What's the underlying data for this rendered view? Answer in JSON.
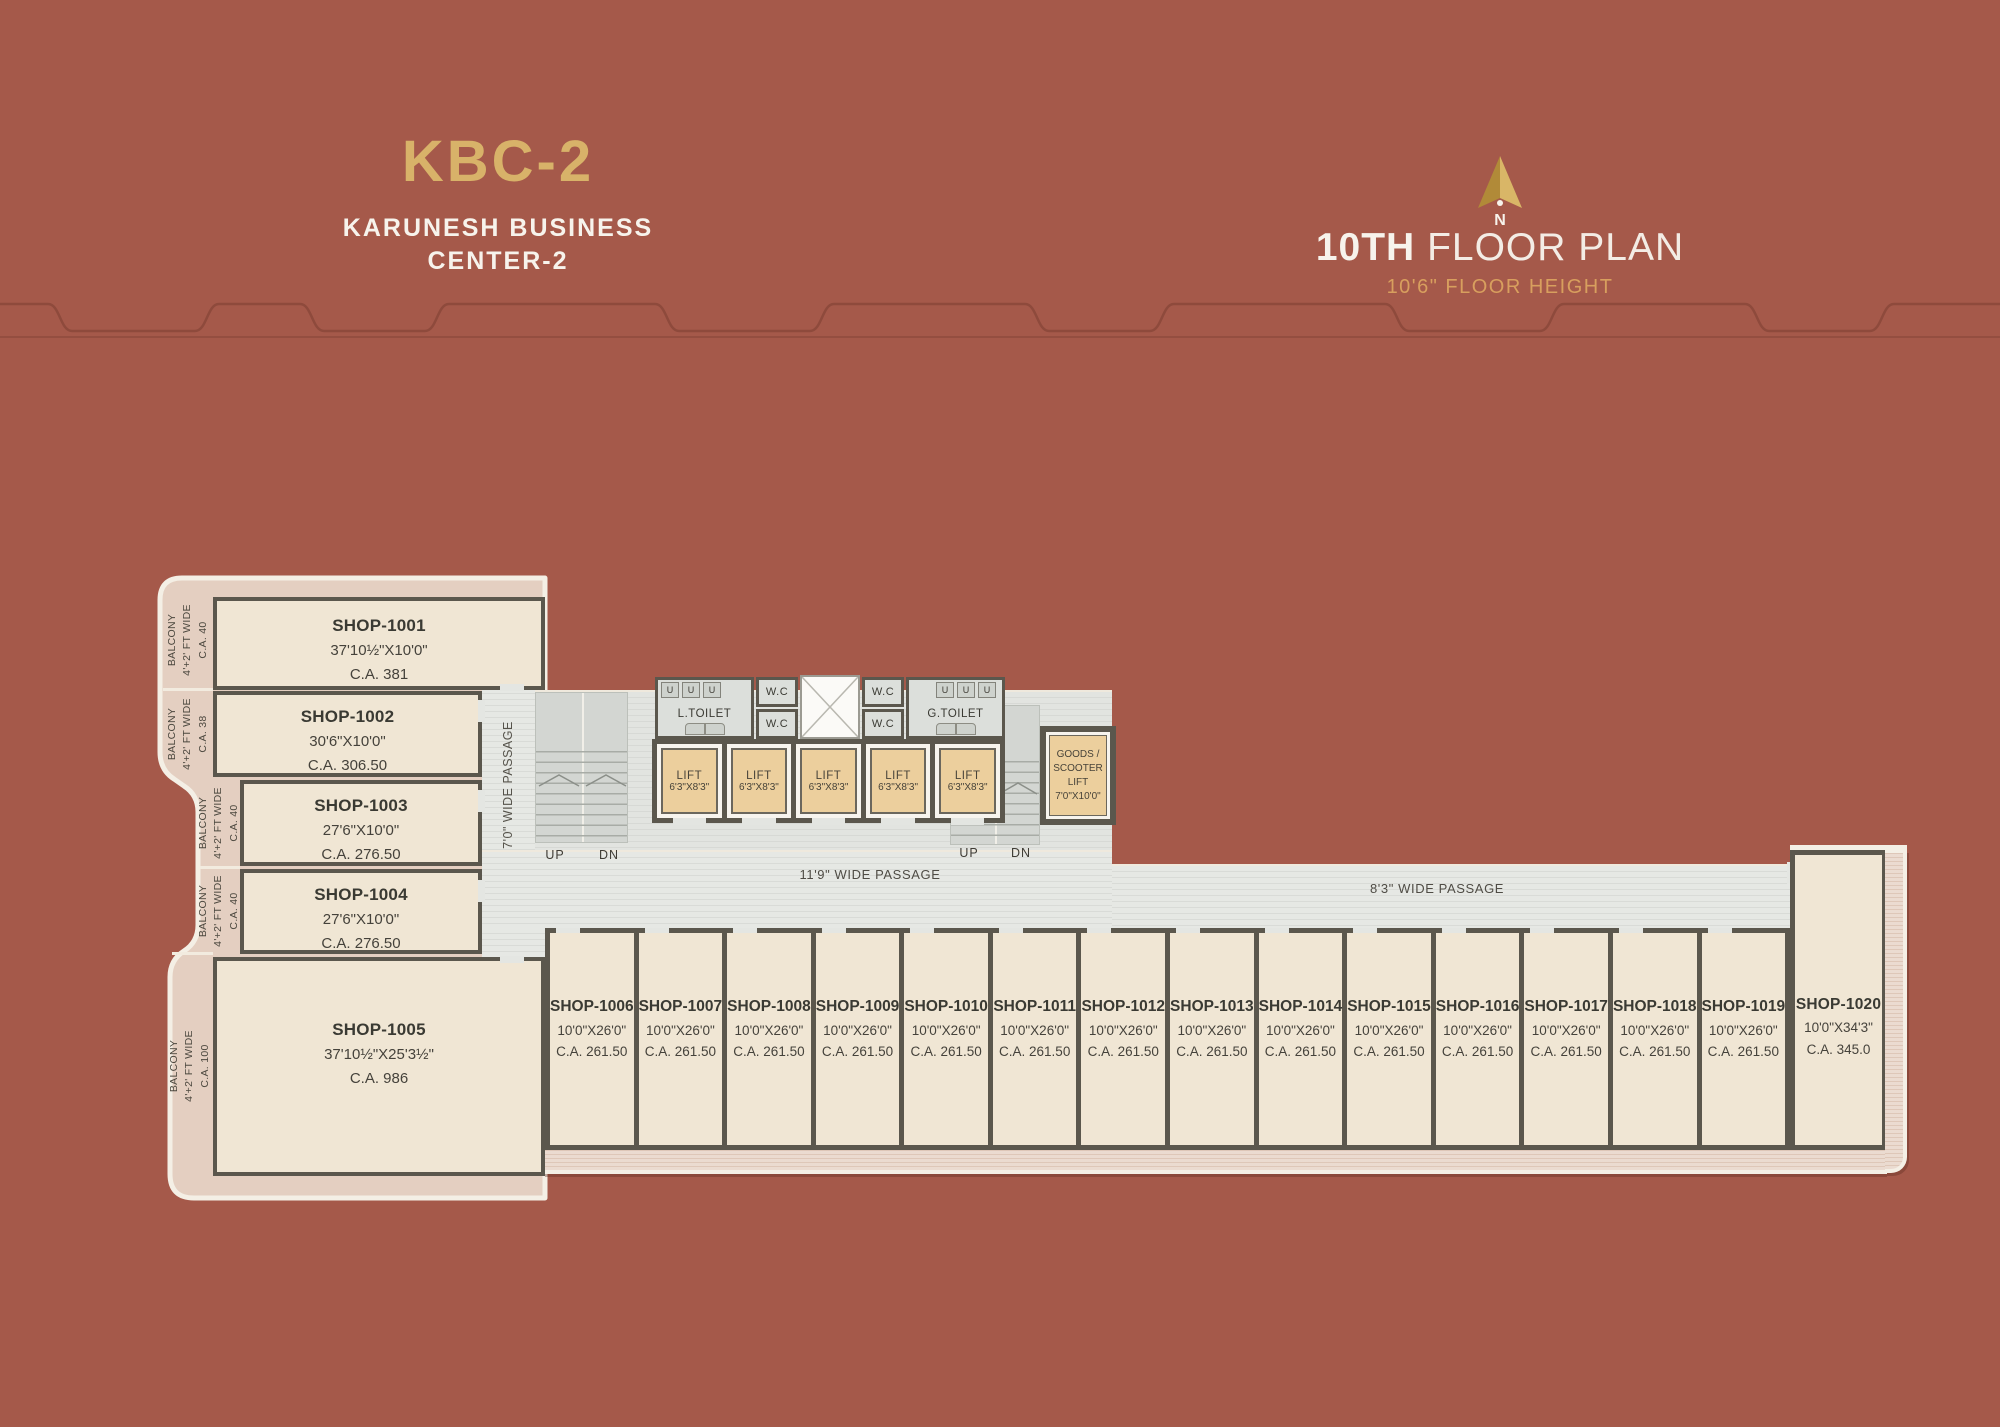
{
  "header": {
    "brand": "KBC-2",
    "brand_sub1": "KARUNESH BUSINESS",
    "brand_sub2": "CENTER-2",
    "north_letter": "N",
    "floor_title_bold": "10TH",
    "floor_title_rest": " FLOOR PLAN",
    "floor_height": "10'6\" FLOOR HEIGHT"
  },
  "plan": {
    "passage_vertical": "7'0\" WIDE PASSAGE",
    "passage_main": "11'9\" WIDE PASSAGE",
    "passage_right": "8'3\" WIDE PASSAGE",
    "stairs": {
      "up": "UP",
      "dn": "DN"
    },
    "core": {
      "l_toilet": "L.TOILET",
      "g_toilet": "G.TOILET",
      "wc": "W.C",
      "urinal": "U",
      "lift_label": "LIFT",
      "lift_size": "6'3\"X8'3\"",
      "goods_lift_lines": [
        "GOODS /",
        "SCOOTER",
        "LIFT",
        "7'0\"X10'0\""
      ]
    }
  },
  "balcony_label": {
    "line1": "BALCONY",
    "line2": "4'+2' FT WIDE"
  },
  "left_shops": [
    {
      "name": "SHOP-1001",
      "size": "37'10½\"X10'0\"",
      "ca": "C.A. 381",
      "balcony_ca": "C.A. 40"
    },
    {
      "name": "SHOP-1002",
      "size": "30'6\"X10'0\"",
      "ca": "C.A. 306.50",
      "balcony_ca": "C.A. 38"
    },
    {
      "name": "SHOP-1003",
      "size": "27'6\"X10'0\"",
      "ca": "C.A. 276.50",
      "balcony_ca": "C.A. 40"
    },
    {
      "name": "SHOP-1004",
      "size": "27'6\"X10'0\"",
      "ca": "C.A. 276.50",
      "balcony_ca": "C.A. 40"
    },
    {
      "name": "SHOP-1005",
      "size": "37'10½\"X25'3½\"",
      "ca": "C.A. 986",
      "balcony_ca": "C.A. 100"
    }
  ],
  "bottom_shops": [
    {
      "name": "SHOP-1006",
      "size": "10'0\"X26'0\"",
      "ca": "C.A. 261.50"
    },
    {
      "name": "SHOP-1007",
      "size": "10'0\"X26'0\"",
      "ca": "C.A. 261.50"
    },
    {
      "name": "SHOP-1008",
      "size": "10'0\"X26'0\"",
      "ca": "C.A. 261.50"
    },
    {
      "name": "SHOP-1009",
      "size": "10'0\"X26'0\"",
      "ca": "C.A. 261.50"
    },
    {
      "name": "SHOP-1010",
      "size": "10'0\"X26'0\"",
      "ca": "C.A. 261.50"
    },
    {
      "name": "SHOP-1011",
      "size": "10'0\"X26'0\"",
      "ca": "C.A. 261.50"
    },
    {
      "name": "SHOP-1012",
      "size": "10'0\"X26'0\"",
      "ca": "C.A. 261.50"
    },
    {
      "name": "SHOP-1013",
      "size": "10'0\"X26'0\"",
      "ca": "C.A. 261.50"
    },
    {
      "name": "SHOP-1014",
      "size": "10'0\"X26'0\"",
      "ca": "C.A. 261.50"
    },
    {
      "name": "SHOP-1015",
      "size": "10'0\"X26'0\"",
      "ca": "C.A. 261.50"
    },
    {
      "name": "SHOP-1016",
      "size": "10'0\"X26'0\"",
      "ca": "C.A. 261.50"
    },
    {
      "name": "SHOP-1017",
      "size": "10'0\"X26'0\"",
      "ca": "C.A. 261.50"
    },
    {
      "name": "SHOP-1018",
      "size": "10'0\"X26'0\"",
      "ca": "C.A. 261.50"
    },
    {
      "name": "SHOP-1019",
      "size": "10'0\"X26'0\"",
      "ca": "C.A. 261.50"
    }
  ],
  "shop_1020": {
    "name": "SHOP-1020",
    "size": "10'0\"X34'3\"",
    "ca": "C.A. 345.0"
  },
  "colors": {
    "background": "#a5594a",
    "decor_line": "#8e4a3c",
    "brand_gold": "#d8b269",
    "floor_height_gold": "#d89f5e",
    "shop_cream": "#f0e6d4",
    "balcony_blush": "#e4cfc1",
    "wall_dark": "#5b574d",
    "passage_gray": "#e0e2de",
    "lift_tan": "#eccf9d",
    "outline_white": "#f4efe5",
    "text_ink": "#3a3a33"
  }
}
